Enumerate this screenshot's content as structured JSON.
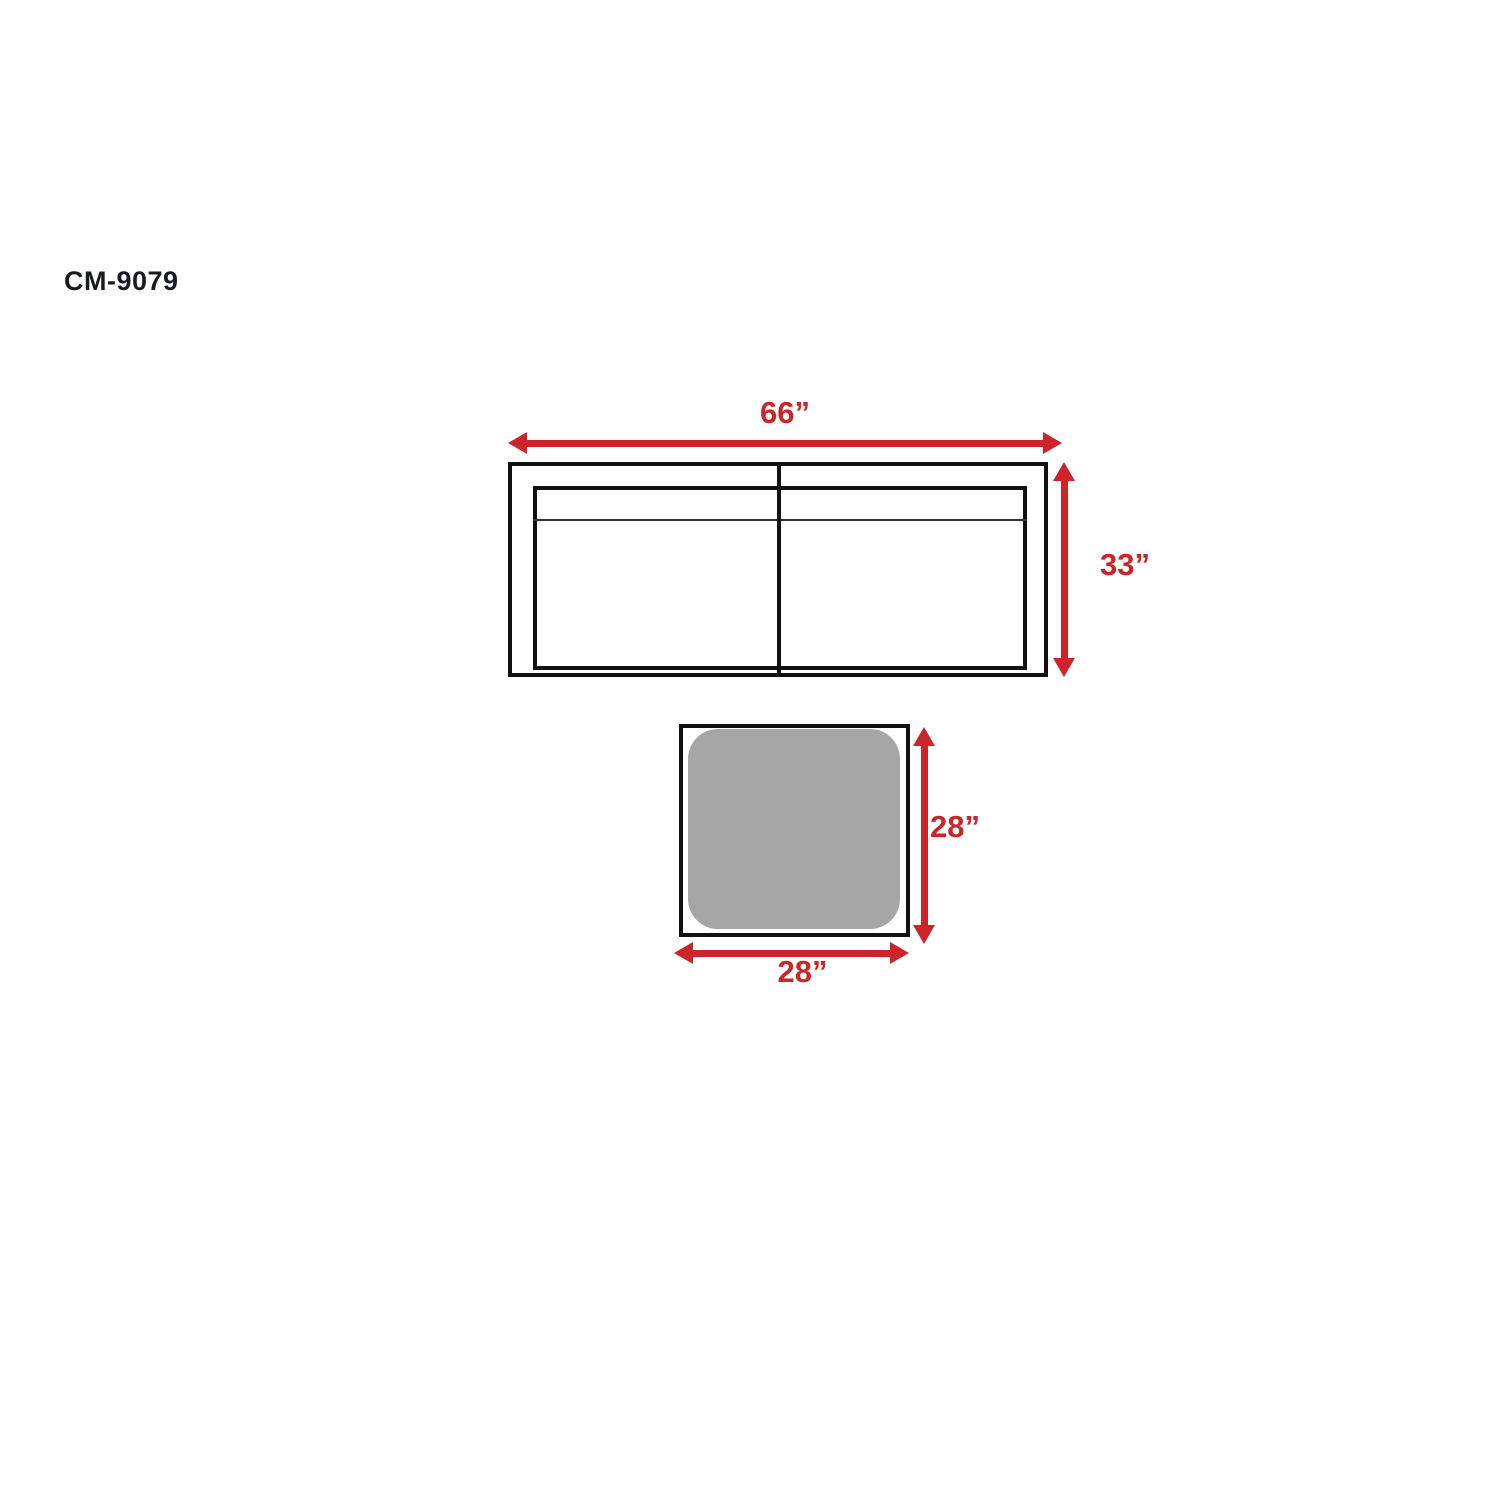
{
  "title": "CM-9079",
  "colors": {
    "dimension_red": "#cc2428",
    "line_black": "#111111",
    "ottoman_gray": "#a6a6a6",
    "title_black": "#1a1a22",
    "background": "#ffffff"
  },
  "sofa": {
    "width_label": "66”",
    "depth_label": "33”"
  },
  "ottoman": {
    "width_label": "28”",
    "depth_label": "28”"
  }
}
